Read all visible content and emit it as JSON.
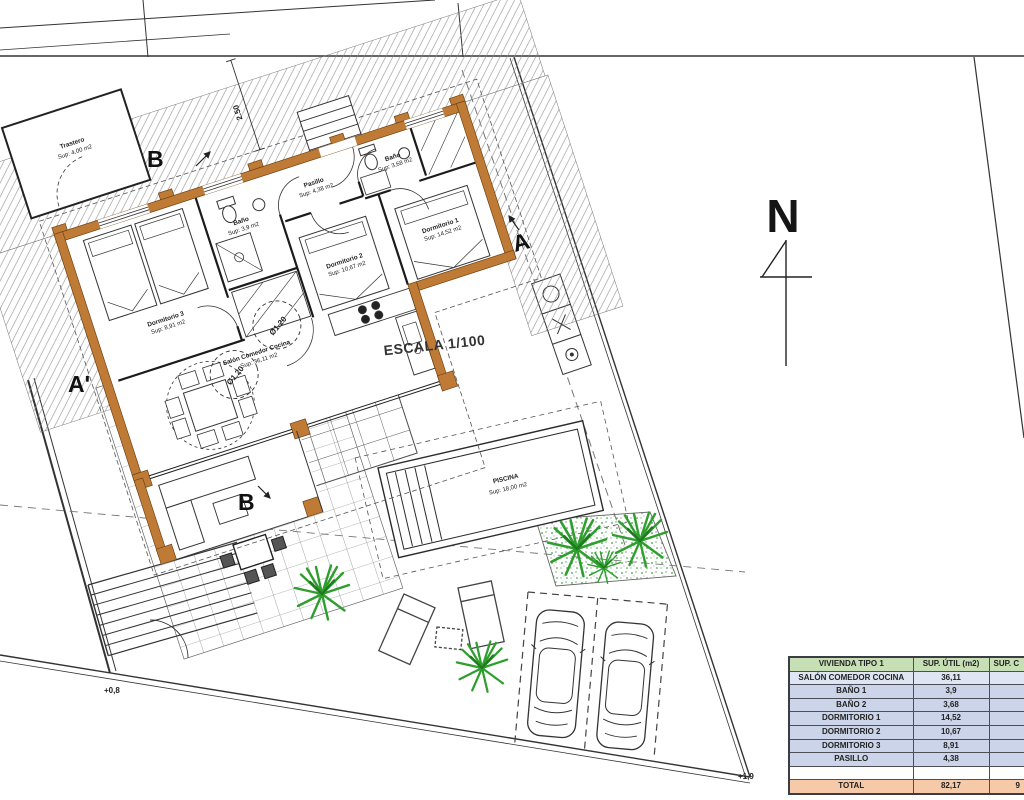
{
  "plan": {
    "scale": "ESCALA 1/100",
    "north": "N",
    "markers": {
      "a": "A",
      "a_prime": "A'",
      "b_top": "B",
      "b_bottom": "B"
    },
    "dims": {
      "setback": "2.50",
      "circle_a": "Ø1.20",
      "circle_b": "Ø1.20"
    },
    "levels": {
      "patio": "+0,8",
      "street": "+1,9"
    },
    "rooms": {
      "trastero": {
        "name": "Trastero",
        "area": "Sup: 4,00 m2"
      },
      "dormitorio3": {
        "name": "Dormitorio 3",
        "area": "Sup: 8,91 m2"
      },
      "bano1": {
        "name": "Baño",
        "area": "Sup: 3,9 m2"
      },
      "pasillo": {
        "name": "Pasillo",
        "area": "Sup: 4,38 m2"
      },
      "bano2": {
        "name": "Baño",
        "area": "Sup: 3,68 m2"
      },
      "dormitorio2": {
        "name": "Dormitorio 2",
        "area": "Sup: 10,67 m2"
      },
      "dormitorio1": {
        "name": "Dormitorio 1",
        "area": "Sup: 14,52 m2"
      },
      "salon": {
        "name": "Salón Comedor Cocina",
        "area": "Sup: 36,11 m2"
      },
      "piscina": {
        "name": "PISCINA",
        "area": "Sup: 18,00 m2"
      }
    }
  },
  "table": {
    "headers": {
      "name": "VIVIENDA TIPO 1",
      "util": "SUP. ÚTIL (m2)",
      "col3": "SUP. C"
    },
    "rows": [
      {
        "label": "SALÓN COMEDOR COCINA",
        "util": "36,11"
      },
      {
        "label": "BAÑO 1",
        "util": "3,9"
      },
      {
        "label": "BAÑO 2",
        "util": "3,68"
      },
      {
        "label": "DORMITORIO 1",
        "util": "14,52"
      },
      {
        "label": "DORMITORIO 2",
        "util": "10,67"
      },
      {
        "label": "DORMITORIO 3",
        "util": "8,91"
      },
      {
        "label": "PASILLO",
        "util": "4,38"
      },
      {
        "label": "",
        "util": ""
      }
    ],
    "total": {
      "label": "TOTAL",
      "util": "82,17",
      "col3": "9"
    }
  },
  "colors": {
    "wall_orange": "#bf7b35",
    "header_green": "#c6dfb4",
    "row_blue": "#cbd4e8",
    "total_orange": "#f6caa9",
    "plant_green": "#2f9e2f"
  }
}
